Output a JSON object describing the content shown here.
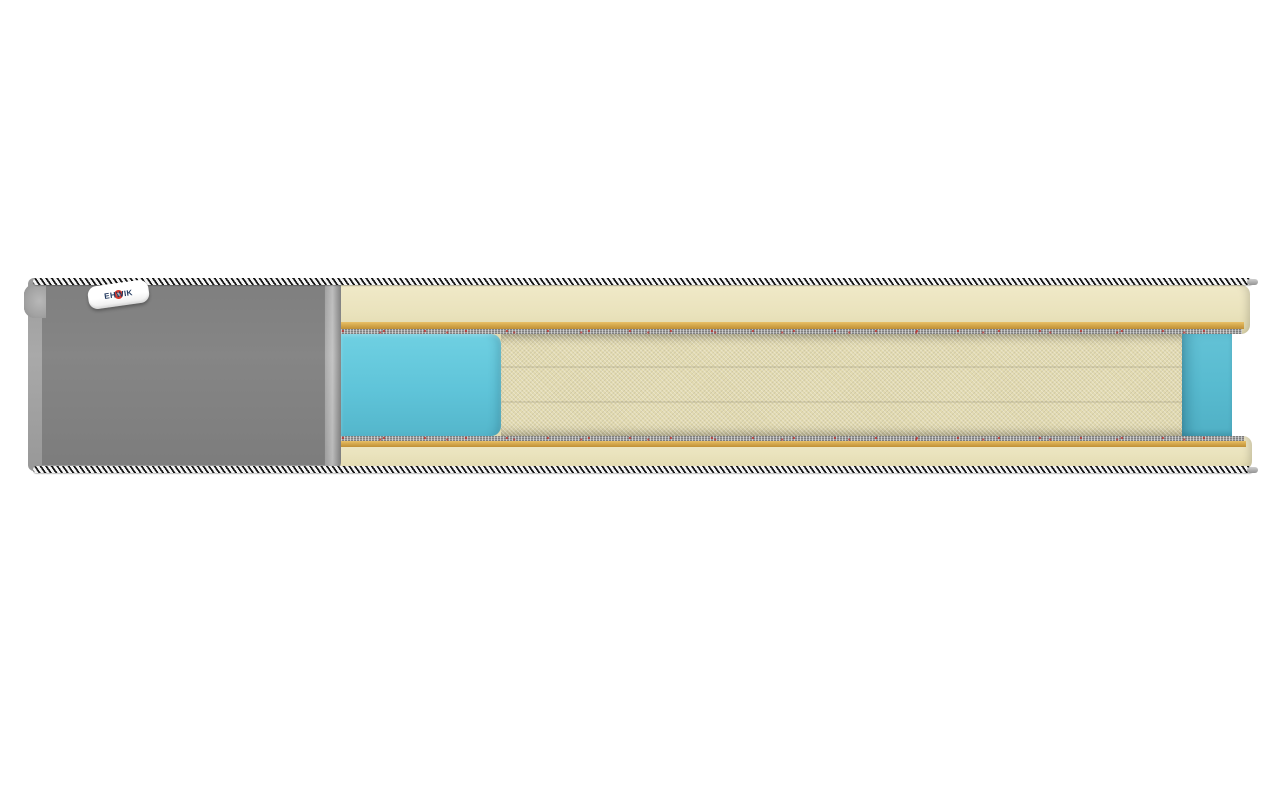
{
  "scene": {
    "type": "product-render",
    "subject": "pocket-spring mattress cross-section cutaway",
    "background_color": "#ffffff"
  },
  "brand_label": {
    "text": "EHWIK",
    "text_color": "#22395f",
    "logo_color": "#d63a2e",
    "background": "#ffffff"
  },
  "colors": {
    "cover_base": "#a7a7a7",
    "cover_light": "#bdbdbd",
    "cover_dark": "#8d8d8d",
    "piping_dark": "#161616",
    "piping_light": "#f4f4f4",
    "foam_cream": "#eae3bd",
    "foam_cream_light": "#f0e9c8",
    "foam_cream_dark": "#e2dab0",
    "tan_light": "#e9c067",
    "tan_mid": "#d5a94e",
    "tan_dark": "#c08f35",
    "felt_gray": "#a2a2a2",
    "turquoise_light": "#6fd0e2",
    "turquoise_mid": "#5fc4d9",
    "turquoise_dark": "#54b6cb",
    "turquoise_back": "#58bbd0",
    "spring_light": "#efefef",
    "spring_edge": "#8e8e8e",
    "spring_gap": "#7f7f7f"
  },
  "structure": {
    "quilt_cols": 9,
    "quilt_rows": 5,
    "scallop_count": 5,
    "spring_count": 26,
    "visible_layers": [
      "striped piping cord (top)",
      "grey quilted cover (left)",
      "cream comfort foam (top)",
      "gold fiber pad",
      "grey felt pad",
      "turquoise foam side block",
      "white pocket spring coils",
      "turquoise foam back wall",
      "grey felt pad",
      "gold fiber pad",
      "cream comfort foam (bottom)",
      "striped piping cord (bottom)"
    ]
  }
}
